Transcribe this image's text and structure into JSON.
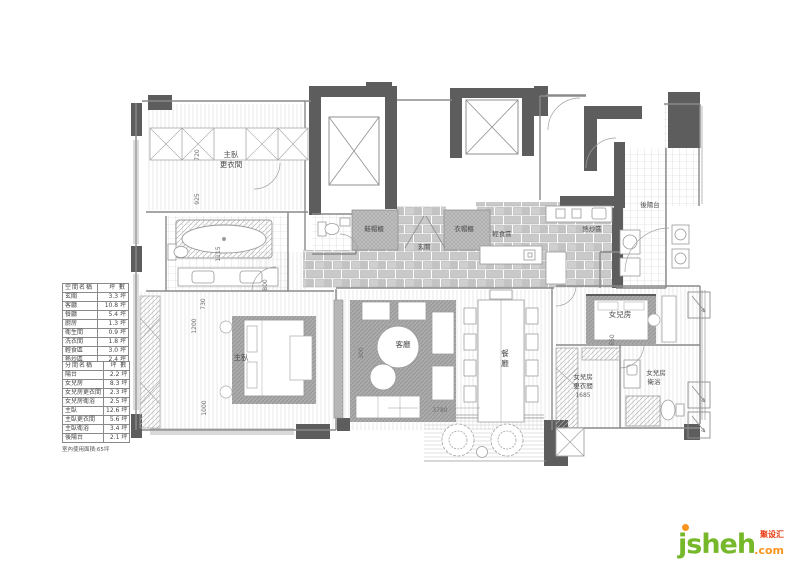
{
  "note": "室內使用面積:65坪",
  "tables": {
    "space": {
      "col_name": "空間名稱",
      "col_area": "坪 數",
      "rows": [
        {
          "name": "玄關",
          "area": "3.3 坪"
        },
        {
          "name": "客廳",
          "area": "10.8 坪"
        },
        {
          "name": "餐廳",
          "area": "5.4 坪"
        },
        {
          "name": "廚房",
          "area": "1.3 坪"
        },
        {
          "name": "衛生間",
          "area": "0.9 坪"
        },
        {
          "name": "洗衣間",
          "area": "1.8 坪"
        },
        {
          "name": "輕食區",
          "area": "3.0 坪"
        },
        {
          "name": "熱炒區",
          "area": "2.4 坪"
        }
      ]
    },
    "rooms": {
      "col_name": "分間名稱",
      "col_area": "坪 數",
      "rows": [
        {
          "name": "陽台",
          "area": "2.2 坪"
        },
        {
          "name": "女兒房",
          "area": "8.3 坪"
        },
        {
          "name": "女兒房更衣間",
          "area": "2.3 坪"
        },
        {
          "name": "女兒房衛浴",
          "area": "2.5 坪"
        },
        {
          "name": "主臥",
          "area": "12.6 坪"
        },
        {
          "name": "主臥更衣間",
          "area": "5.6 坪"
        },
        {
          "name": "主臥衛浴",
          "area": "3.4 坪"
        },
        {
          "name": "後陽台",
          "area": "2.1 坪"
        }
      ]
    }
  },
  "rooms": {
    "master_closet_l1": "主臥",
    "master_closet_l2": "更衣間",
    "master": "主臥",
    "living": "客廳",
    "dining_c1": "餐",
    "dining_c2": "廳",
    "entry": "玄關",
    "cab_left": "鞋帽櫃",
    "cab_right": "衣帽櫃",
    "light_meal": "輕食區",
    "hot_cook": "熱炒區",
    "back_balcony": "後陽台",
    "daughter": "女兒房",
    "d_closet_l1": "女兒房",
    "d_closet_l2": "更衣間",
    "d_closet_dim": "1685",
    "d_bath_l1": "女兒房",
    "d_bath_l2": "衛浴"
  },
  "dims": {
    "d720": "720",
    "d925": "925",
    "d1115": "1115",
    "d730": "730",
    "d800": "800",
    "d1200": "1200",
    "d1000": "1000",
    "d300": "300",
    "d650": "650",
    "d3780": "3780"
  },
  "logo": {
    "brand": "jsheh",
    "tld": ".com",
    "cn": "聚设汇",
    "green": "#76b82a",
    "orange": "#f7941d",
    "red": "#e8380d"
  }
}
